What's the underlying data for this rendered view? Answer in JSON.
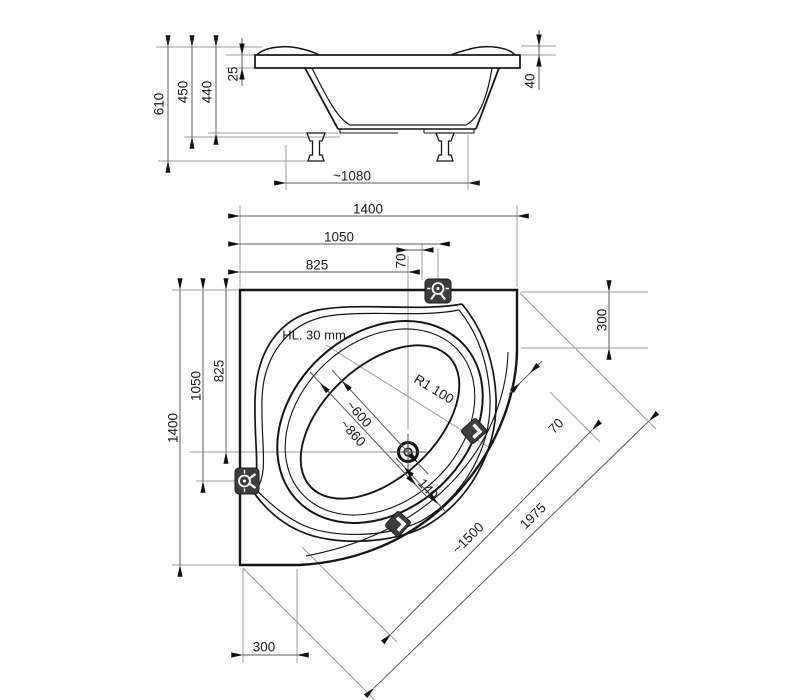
{
  "side_view": {
    "dims": {
      "total_height": "610",
      "height_to_frame": "450",
      "height_to_shell": "440",
      "rim_lip": "25",
      "rim_edge": "40",
      "feet_span": "~1080"
    }
  },
  "plan_view": {
    "dims": {
      "width_total": "1400",
      "width_to_faucet": "1050",
      "width_to_drain": "825",
      "faucet_offset": "70",
      "depth_total": "1400",
      "depth_to_jet": "1050",
      "depth_to_drain": "825",
      "right_edge": "300",
      "bottom_edge": "300",
      "diagonal_overall": "1975",
      "diagonal_front": "~1500",
      "diagonal_offset": "70",
      "well_minor_inner": "~600",
      "well_minor_outer": "~860",
      "drain_to_wall": "140",
      "corner_radius": "R1 100",
      "headrest_note": "HL. 30 mm"
    }
  }
}
